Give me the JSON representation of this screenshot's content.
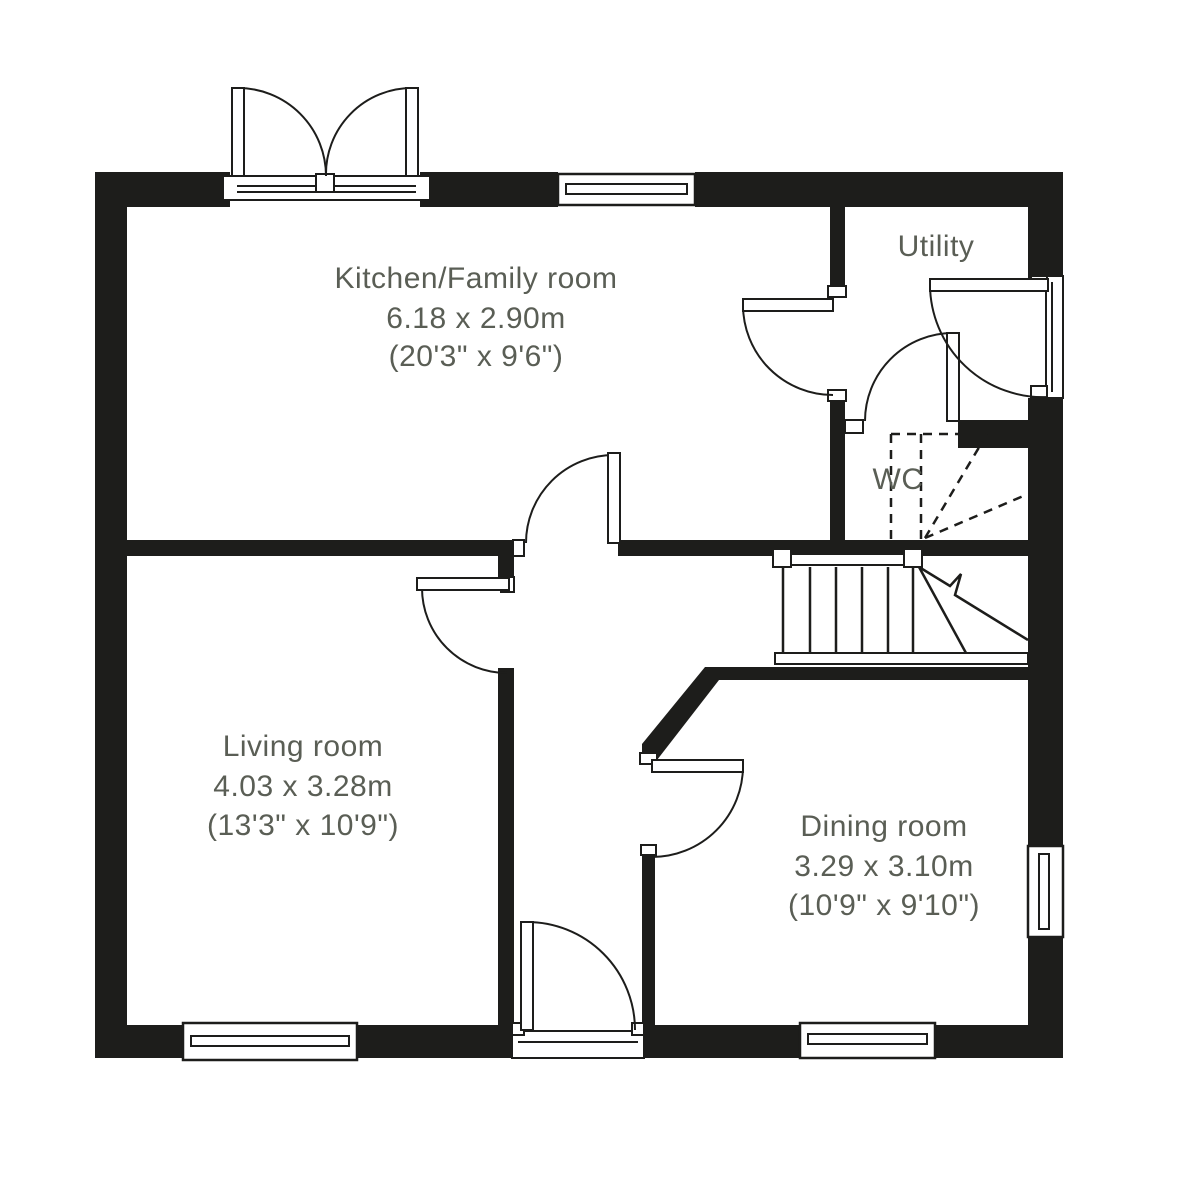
{
  "plan": {
    "rooms": {
      "kitchen": {
        "name": "Kitchen/Family room",
        "metric": "6.18 x 2.90m",
        "imperial": "(20'3\" x 9'6\")"
      },
      "living": {
        "name": "Living room",
        "metric": "4.03 x 3.28m",
        "imperial": "(13'3\" x 10'9\")"
      },
      "dining": {
        "name": "Dining room",
        "metric": "3.29 x 3.10m",
        "imperial": "(10'9\" x 9'10\")"
      },
      "utility": {
        "name": "Utility"
      },
      "wc": {
        "name": "WC"
      }
    },
    "colors": {
      "wall": "#1d1d1b",
      "text": "#5a5e55",
      "background": "#ffffff"
    }
  }
}
